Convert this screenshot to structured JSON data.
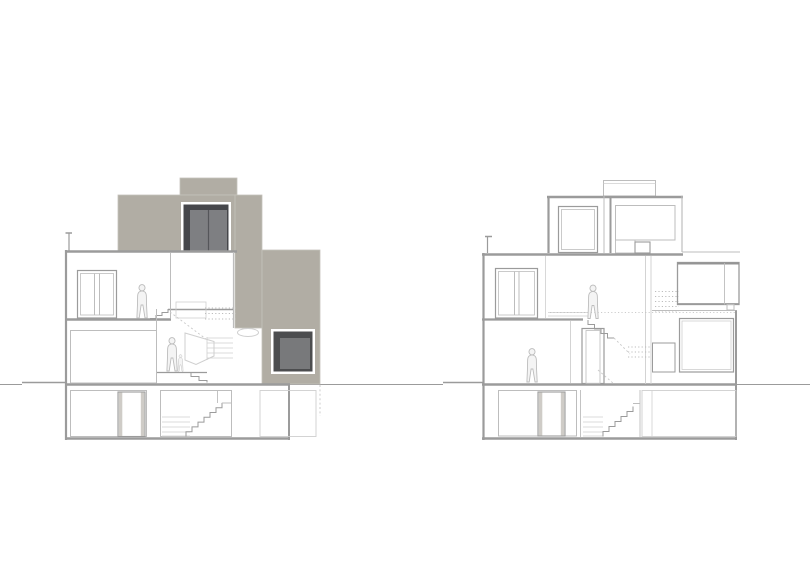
{
  "drawing": {
    "type": "architectural-cross-sections",
    "panel_count": 2,
    "figure_count": 4,
    "panels": [
      {
        "id": "left-section",
        "description": "three-storey house section with grey elevation masses behind",
        "floors": 3,
        "has_basement": true,
        "figures": 2,
        "dark_openings": 2,
        "grey_masses": 4
      },
      {
        "id": "right-section",
        "description": "three-storey split-level house section, pure line drawing",
        "floors": 3,
        "has_basement": true,
        "figures": 2,
        "dark_openings": 0,
        "grey_masses": 0
      }
    ]
  },
  "colors": {
    "background": "#ffffff",
    "line_mid": "#9b9b9b",
    "line_light": "#bdbdbd",
    "fill_taupe": "#b1ada4",
    "taupe_border": "#c5c2bb",
    "window_dark": "#46474b",
    "window_panel": "#7e7f82",
    "window_dark2": "#4c4d4f",
    "window_panel2": "#78797b",
    "figure_stroke": "#bdbdbd",
    "figure_fill": "#f4f4f4",
    "door_jamb": "#cfccc7"
  }
}
